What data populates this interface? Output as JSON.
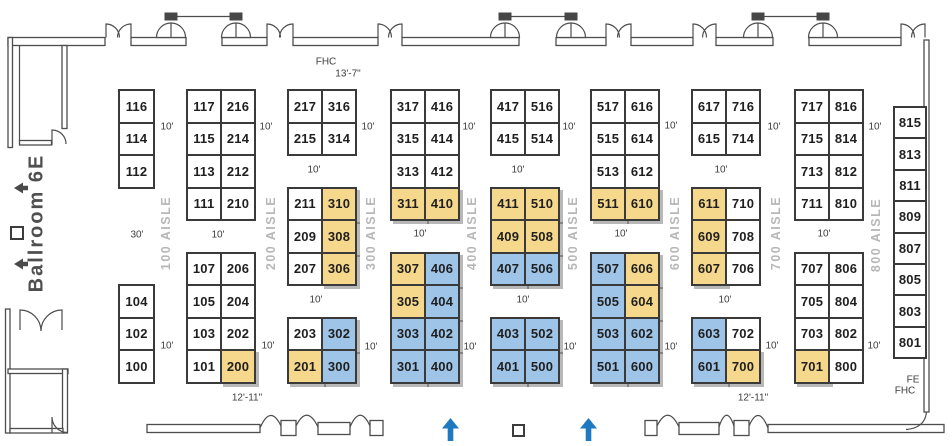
{
  "colors": {
    "booth_white": "#ffffff",
    "booth_yellow": "#f6d88c",
    "booth_blue": "#9ec4e8",
    "booth_border": "#3a3a3a",
    "booth_text": "#1f1f1f",
    "aisle_text": "#b7b7b7",
    "dim_text": "#3d3d3d",
    "wall": "#4d4d4d",
    "arrow_blue": "#1e79c0",
    "arrow_gray": "#4a4a4a",
    "ballroom_text": "#4f4f4f"
  },
  "ballroom": {
    "label": "Ballroom 6E"
  },
  "aisles": [
    {
      "label": "100 AISLE",
      "x": 166,
      "y": 233
    },
    {
      "label": "200 AISLE",
      "x": 271,
      "y": 233
    },
    {
      "label": "300 AISLE",
      "x": 371,
      "y": 233
    },
    {
      "label": "400 AISLE",
      "x": 472,
      "y": 233
    },
    {
      "label": "500 AISLE",
      "x": 573,
      "y": 233
    },
    {
      "label": "600 AISLE",
      "x": 675,
      "y": 233
    },
    {
      "label": "700 AISLE",
      "x": 776,
      "y": 233
    },
    {
      "label": "800 AISLE",
      "x": 876,
      "y": 235
    }
  ],
  "booth_grid": {
    "y0": 89,
    "row_h": 32.5,
    "cell_w": 34,
    "columns": [
      {
        "x": 118,
        "cell_w": 35,
        "groups": [
          {
            "r": 0,
            "rows": [
              [
                [
                  "116",
                  "w"
                ]
              ],
              [
                [
                  "114",
                  "w"
                ]
              ],
              [
                [
                  "112",
                  "w"
                ]
              ]
            ]
          },
          {
            "r": 6,
            "rows": [
              [
                [
                  "104",
                  "w"
                ]
              ],
              [
                [
                  "102",
                  "w"
                ]
              ],
              [
                [
                  "100",
                  "w"
                ]
              ]
            ]
          }
        ]
      },
      {
        "x": 186,
        "groups": [
          {
            "r": 0,
            "rows": [
              [
                [
                  "117",
                  "w"
                ],
                [
                  "216",
                  "w"
                ]
              ],
              [
                [
                  "115",
                  "w"
                ],
                [
                  "214",
                  "w"
                ]
              ],
              [
                [
                  "113",
                  "w"
                ],
                [
                  "212",
                  "w"
                ]
              ],
              [
                [
                  "111",
                  "w"
                ],
                [
                  "210",
                  "w"
                ]
              ]
            ]
          },
          {
            "r": 5,
            "rows": [
              [
                [
                  "107",
                  "w"
                ],
                [
                  "206",
                  "w"
                ]
              ],
              [
                [
                  "105",
                  "w"
                ],
                [
                  "204",
                  "w"
                ]
              ],
              [
                [
                  "103",
                  "w"
                ],
                [
                  "202",
                  "w"
                ]
              ],
              [
                [
                  "101",
                  "w"
                ],
                [
                  "200",
                  "y"
                ]
              ]
            ]
          }
        ]
      },
      {
        "x": 287,
        "groups": [
          {
            "r": 0,
            "rows": [
              [
                [
                  "217",
                  "w"
                ],
                [
                  "316",
                  "w"
                ]
              ],
              [
                [
                  "215",
                  "w"
                ],
                [
                  "314",
                  "w"
                ]
              ]
            ]
          },
          {
            "r": 3,
            "rows": [
              [
                [
                  "211",
                  "w"
                ],
                [
                  "310",
                  "y"
                ]
              ],
              [
                [
                  "209",
                  "w"
                ],
                [
                  "308",
                  "y"
                ]
              ],
              [
                [
                  "207",
                  "w"
                ],
                [
                  "306",
                  "y"
                ]
              ]
            ]
          },
          {
            "r": 7,
            "rows": [
              [
                [
                  "203",
                  "w"
                ],
                [
                  "302",
                  "b"
                ]
              ],
              [
                [
                  "201",
                  "y"
                ],
                [
                  "300",
                  "b"
                ]
              ]
            ]
          }
        ]
      },
      {
        "x": 390,
        "groups": [
          {
            "r": 0,
            "rows": [
              [
                [
                  "317",
                  "w"
                ],
                [
                  "416",
                  "w"
                ]
              ],
              [
                [
                  "315",
                  "w"
                ],
                [
                  "414",
                  "w"
                ]
              ],
              [
                [
                  "313",
                  "w"
                ],
                [
                  "412",
                  "w"
                ]
              ],
              [
                [
                  "311",
                  "y"
                ],
                [
                  "410",
                  "y"
                ]
              ]
            ]
          },
          {
            "r": 5,
            "rows": [
              [
                [
                  "307",
                  "y"
                ],
                [
                  "406",
                  "b"
                ]
              ],
              [
                [
                  "305",
                  "y"
                ],
                [
                  "404",
                  "b"
                ]
              ],
              [
                [
                  "303",
                  "b"
                ],
                [
                  "402",
                  "b"
                ]
              ],
              [
                [
                  "301",
                  "b"
                ],
                [
                  "400",
                  "b"
                ]
              ]
            ]
          }
        ]
      },
      {
        "x": 490,
        "groups": [
          {
            "r": 0,
            "rows": [
              [
                [
                  "417",
                  "w"
                ],
                [
                  "516",
                  "w"
                ]
              ],
              [
                [
                  "415",
                  "w"
                ],
                [
                  "514",
                  "w"
                ]
              ]
            ]
          },
          {
            "r": 3,
            "rows": [
              [
                [
                  "411",
                  "y"
                ],
                [
                  "510",
                  "y"
                ]
              ],
              [
                [
                  "409",
                  "y"
                ],
                [
                  "508",
                  "y"
                ]
              ],
              [
                [
                  "407",
                  "b"
                ],
                [
                  "506",
                  "b"
                ]
              ]
            ]
          },
          {
            "r": 7,
            "rows": [
              [
                [
                  "403",
                  "b"
                ],
                [
                  "502",
                  "b"
                ]
              ],
              [
                [
                  "401",
                  "b"
                ],
                [
                  "500",
                  "b"
                ]
              ]
            ]
          }
        ]
      },
      {
        "x": 590,
        "groups": [
          {
            "r": 0,
            "rows": [
              [
                [
                  "517",
                  "w"
                ],
                [
                  "616",
                  "w"
                ]
              ],
              [
                [
                  "515",
                  "w"
                ],
                [
                  "614",
                  "w"
                ]
              ],
              [
                [
                  "513",
                  "w"
                ],
                [
                  "612",
                  "w"
                ]
              ],
              [
                [
                  "511",
                  "y"
                ],
                [
                  "610",
                  "y"
                ]
              ]
            ]
          },
          {
            "r": 5,
            "rows": [
              [
                [
                  "507",
                  "b"
                ],
                [
                  "606",
                  "y"
                ]
              ],
              [
                [
                  "505",
                  "b"
                ],
                [
                  "604",
                  "y"
                ]
              ],
              [
                [
                  "503",
                  "b"
                ],
                [
                  "602",
                  "b"
                ]
              ],
              [
                [
                  "501",
                  "b"
                ],
                [
                  "600",
                  "b"
                ]
              ]
            ]
          }
        ]
      },
      {
        "x": 691,
        "groups": [
          {
            "r": 0,
            "rows": [
              [
                [
                  "617",
                  "w"
                ],
                [
                  "716",
                  "w"
                ]
              ],
              [
                [
                  "615",
                  "w"
                ],
                [
                  "714",
                  "w"
                ]
              ]
            ]
          },
          {
            "r": 3,
            "rows": [
              [
                [
                  "611",
                  "y"
                ],
                [
                  "710",
                  "w"
                ]
              ],
              [
                [
                  "609",
                  "y"
                ],
                [
                  "708",
                  "w"
                ]
              ],
              [
                [
                  "607",
                  "y"
                ],
                [
                  "706",
                  "w"
                ]
              ]
            ]
          },
          {
            "r": 7,
            "rows": [
              [
                [
                  "603",
                  "b"
                ],
                [
                  "702",
                  "w"
                ]
              ],
              [
                [
                  "601",
                  "b"
                ],
                [
                  "700",
                  "y"
                ]
              ]
            ]
          }
        ]
      },
      {
        "x": 794,
        "groups": [
          {
            "r": 0,
            "rows": [
              [
                [
                  "717",
                  "w"
                ],
                [
                  "816",
                  "w"
                ]
              ],
              [
                [
                  "715",
                  "w"
                ],
                [
                  "814",
                  "w"
                ]
              ],
              [
                [
                  "713",
                  "w"
                ],
                [
                  "812",
                  "w"
                ]
              ],
              [
                [
                  "711",
                  "w"
                ],
                [
                  "810",
                  "w"
                ]
              ]
            ]
          },
          {
            "r": 5,
            "rows": [
              [
                [
                  "707",
                  "w"
                ],
                [
                  "806",
                  "w"
                ]
              ],
              [
                [
                  "705",
                  "w"
                ],
                [
                  "804",
                  "w"
                ]
              ],
              [
                [
                  "703",
                  "w"
                ],
                [
                  "802",
                  "w"
                ]
              ],
              [
                [
                  "701",
                  "y"
                ],
                [
                  "800",
                  "w"
                ]
              ]
            ]
          }
        ]
      },
      {
        "x": 893,
        "cell_w": 32,
        "y0": 106,
        "row_h": 31.4,
        "groups": [
          {
            "r": 0,
            "rows": [
              [
                [
                  "815",
                  "w"
                ]
              ],
              [
                [
                  "813",
                  "w"
                ]
              ],
              [
                [
                  "811",
                  "w"
                ]
              ],
              [
                [
                  "809",
                  "w"
                ]
              ],
              [
                [
                  "807",
                  "w"
                ]
              ],
              [
                [
                  "805",
                  "w"
                ]
              ],
              [
                [
                  "803",
                  "w"
                ]
              ],
              [
                [
                  "801",
                  "w"
                ]
              ]
            ]
          }
        ]
      }
    ]
  },
  "dim_labels": [
    {
      "t": "FHC",
      "x": 326,
      "y": 62
    },
    {
      "t": "13'-7\"",
      "x": 348,
      "y": 74
    },
    {
      "t": "10'",
      "x": 167,
      "y": 127
    },
    {
      "t": "10'",
      "x": 266,
      "y": 127
    },
    {
      "t": "10'",
      "x": 368,
      "y": 127
    },
    {
      "t": "10'",
      "x": 469,
      "y": 127
    },
    {
      "t": "10'",
      "x": 569,
      "y": 127
    },
    {
      "t": "10'",
      "x": 671,
      "y": 126
    },
    {
      "t": "10'",
      "x": 774,
      "y": 127
    },
    {
      "t": "10'",
      "x": 875,
      "y": 127
    },
    {
      "t": "10'",
      "x": 314,
      "y": 170
    },
    {
      "t": "10'",
      "x": 518,
      "y": 170
    },
    {
      "t": "10'",
      "x": 721,
      "y": 170
    },
    {
      "t": "30'",
      "x": 137,
      "y": 235
    },
    {
      "t": "10'",
      "x": 218,
      "y": 235
    },
    {
      "t": "10'",
      "x": 420,
      "y": 234
    },
    {
      "t": "10'",
      "x": 621,
      "y": 234
    },
    {
      "t": "10'",
      "x": 824,
      "y": 234
    },
    {
      "t": "10'",
      "x": 316,
      "y": 300
    },
    {
      "t": "10'",
      "x": 523,
      "y": 300
    },
    {
      "t": "10'",
      "x": 725,
      "y": 300
    },
    {
      "t": "10'",
      "x": 167,
      "y": 346
    },
    {
      "t": "10'",
      "x": 268,
      "y": 346
    },
    {
      "t": "10'",
      "x": 371,
      "y": 347
    },
    {
      "t": "10'",
      "x": 470,
      "y": 347
    },
    {
      "t": "10'",
      "x": 570,
      "y": 347
    },
    {
      "t": "10'",
      "x": 671,
      "y": 347
    },
    {
      "t": "10'",
      "x": 772,
      "y": 346
    },
    {
      "t": "10'",
      "x": 874,
      "y": 346
    },
    {
      "t": "12'-11\"",
      "x": 247,
      "y": 398
    },
    {
      "t": "12'-11\"",
      "x": 753,
      "y": 398
    },
    {
      "t": "FE",
      "x": 913,
      "y": 380
    },
    {
      "t": "FHC",
      "x": 905,
      "y": 391
    }
  ],
  "icons": {
    "ballroom_arrow": "left-arrow",
    "entrance_arrow": "up-arrow",
    "marker": "square-outline"
  }
}
